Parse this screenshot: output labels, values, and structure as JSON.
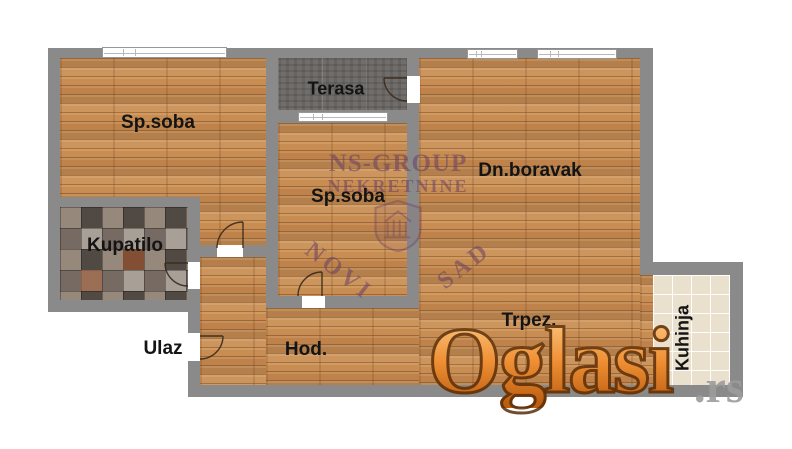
{
  "plan": {
    "labels": {
      "bedroom_left": "Sp.soba",
      "terrace": "Terasa",
      "bedroom_middle": "Sp.soba",
      "living_room": "Dn.boravak",
      "bathroom": "Kupatilo",
      "entrance": "Ulaz",
      "hallway": "Hod.",
      "dining": "Trpez.",
      "kitchen": "Kuhinja"
    },
    "watermarks": {
      "agency_line1": "NS-GROUP",
      "agency_line2": "NEKRETNINE",
      "agency_city_left": "NOVI",
      "agency_city_right": "SAD",
      "site_name": "Oglasi",
      "site_tld": ".rs"
    },
    "colors": {
      "wall": "#8a8a8a",
      "wood_floor": "#c88d52",
      "terrace_floor": "#706d6a",
      "bathroom_tile": "#8a8078",
      "kitchen_tile": "#e9e1cd",
      "label_text": "#141414",
      "agency_watermark": "#683e64",
      "site_watermark_orange": "#ef9035",
      "site_watermark_gray": "#9c9c9c"
    }
  }
}
